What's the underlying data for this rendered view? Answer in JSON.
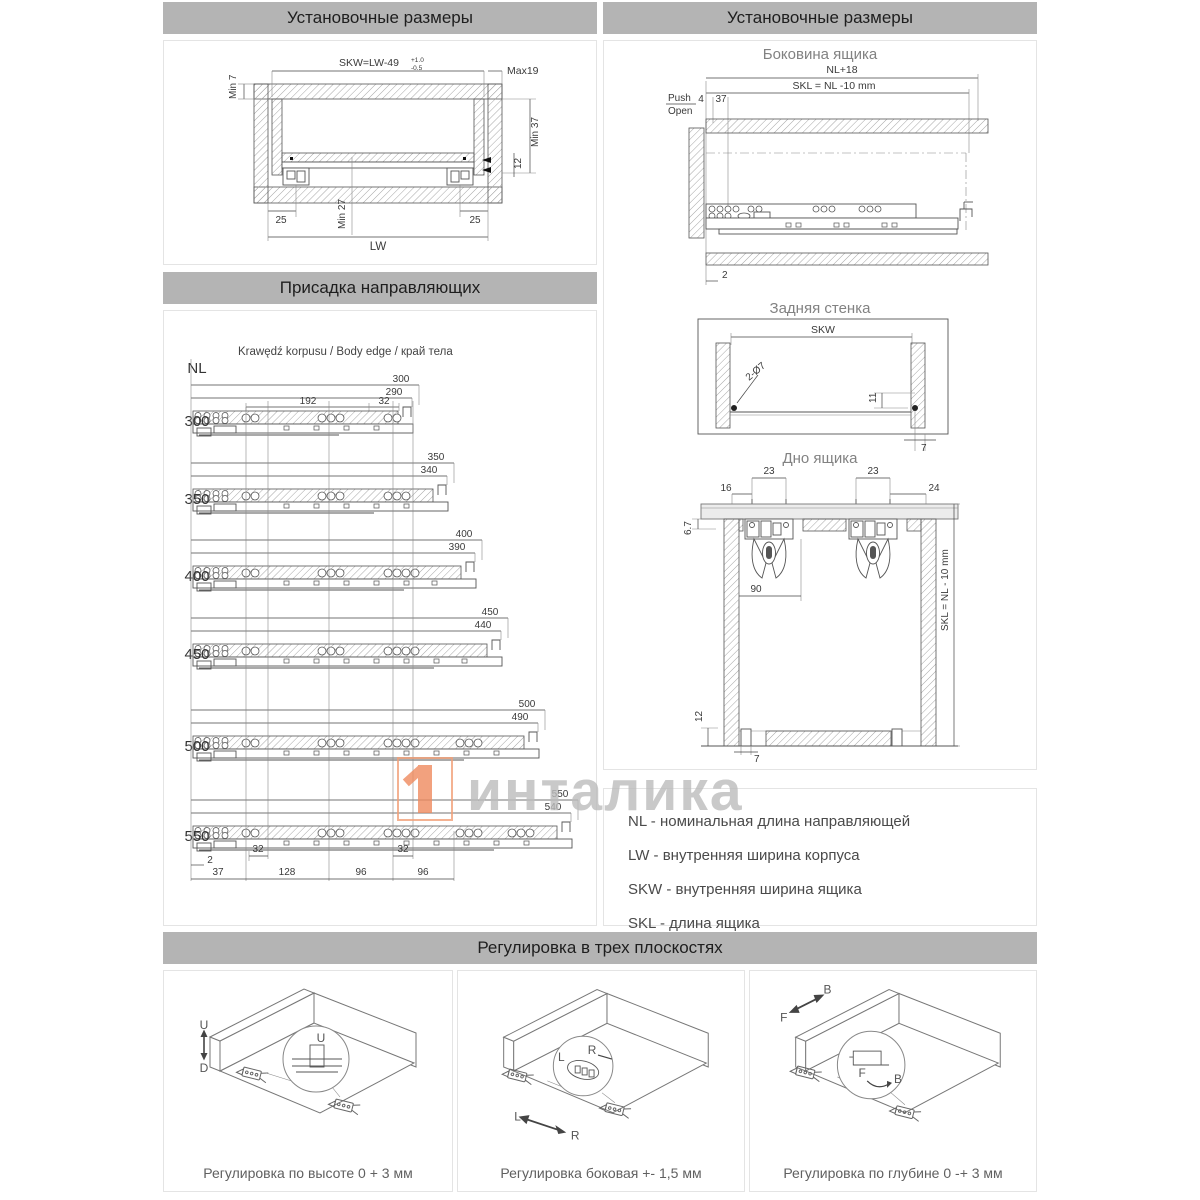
{
  "headers": {
    "install": "Установочные размеры",
    "drilling": "Присадка направляющих",
    "adjustment": "Регулировка в трех плоскостях"
  },
  "cab": {
    "skw": "SKW=LW-49",
    "tol_plus": "+1.0",
    "tol_minus": "-0.5",
    "max19": "Max19",
    "min7": "Min 7",
    "min37": "Min 37",
    "d12": "12",
    "d25l": "25",
    "d25r": "25",
    "min27": "Min 27",
    "lw": "LW"
  },
  "side": {
    "title": "Боковина ящика",
    "nl18": "NL+18",
    "skl": "SKL = NL -10 mm",
    "push": "Push",
    "open": "Open",
    "d4": "4",
    "d37": "37",
    "d2": "2"
  },
  "back": {
    "title": "Задняя стенка",
    "skw": "SKW",
    "holes": "2-Ø7",
    "d11": "11",
    "d7": "7"
  },
  "bottom": {
    "title": "Дно ящика",
    "d23a": "23",
    "d23b": "23",
    "d16": "16",
    "d24": "24",
    "d67": "6.7",
    "d90": "90",
    "skl": "SKL = NL - 10 mm",
    "d12": "12",
    "d7": "7"
  },
  "drill": {
    "edge_label": "Krawędź korpusu / Body edge / край тела",
    "nl": "NL",
    "r0_a": "192",
    "r0_b": "32",
    "rows": [
      {
        "nl": "300",
        "outer": "300",
        "inner": "290"
      },
      {
        "nl": "350",
        "outer": "350",
        "inner": "340"
      },
      {
        "nl": "400",
        "outer": "400",
        "inner": "390"
      },
      {
        "nl": "450",
        "outer": "450",
        "inner": "440"
      },
      {
        "nl": "500",
        "outer": "500",
        "inner": "490"
      },
      {
        "nl": "550",
        "outer": "550",
        "inner": "540"
      }
    ],
    "b2": "2",
    "b37": "37",
    "b32a": "32",
    "b128": "128",
    "b96a": "96",
    "b32b": "32",
    "b96b": "96"
  },
  "legend": {
    "items": [
      "NL - номинальная длина направляющей",
      "LW - внутренняя ширина корпуса",
      "SKW - внутренняя ширина ящика",
      "SKL - длина ящика"
    ]
  },
  "watermark": {
    "text": "инталика"
  },
  "adjust": [
    {
      "caption": "Регулировка по высоте 0 + 3 мм",
      "a": "U",
      "b": "D",
      "ia": "U",
      "ib": ""
    },
    {
      "caption": "Регулировка боковая +- 1,5 мм",
      "a": "L",
      "b": "R",
      "ia": "L",
      "ib": "R"
    },
    {
      "caption": "Регулировка по глубине 0 -+ 3 мм",
      "a": "F",
      "b": "B",
      "ia": "F",
      "ib": "B"
    }
  ]
}
